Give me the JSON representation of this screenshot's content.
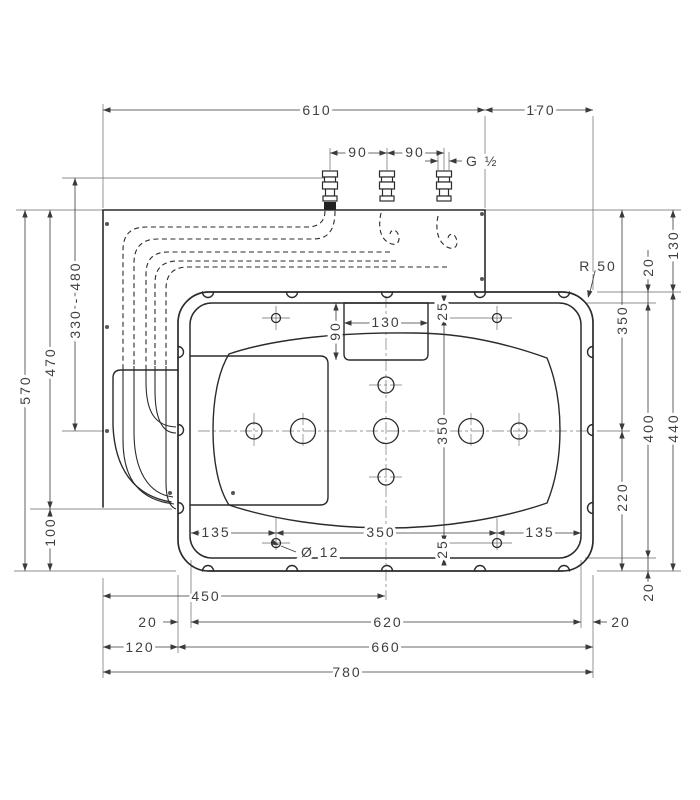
{
  "drawing": {
    "top": {
      "plate_width": "610",
      "side_width": "170",
      "port_gap_1": "90",
      "port_gap_2": "90",
      "thread": "G ½"
    },
    "left": {
      "total_height": "570",
      "height_to_outlet": "470",
      "hose_range": "330 - 480",
      "outlet_to_bottom": "100"
    },
    "right": {
      "plate_height": "130",
      "edge_gap_top": "20",
      "top_to_center": "350",
      "frame_height": "400",
      "body_height": "440",
      "center_to_bottom": "220",
      "edge_gap_bottom": "20",
      "corner_radius": "R 50"
    },
    "inner": {
      "cutout_width": "130",
      "cutout_height": "90",
      "hole_offset_top": "25",
      "hole_span_v": "350",
      "hole_offset_bottom": "25",
      "hole_inset_left": "135",
      "hole_span_h": "350",
      "hole_inset_right": "135",
      "hole_dia": "Ø 12"
    },
    "bottom": {
      "left_to_center": "450",
      "gap_left": "20",
      "frame_width": "620",
      "gap_right": "20",
      "overhang_left": "120",
      "body_width": "660",
      "total_width": "780"
    }
  }
}
